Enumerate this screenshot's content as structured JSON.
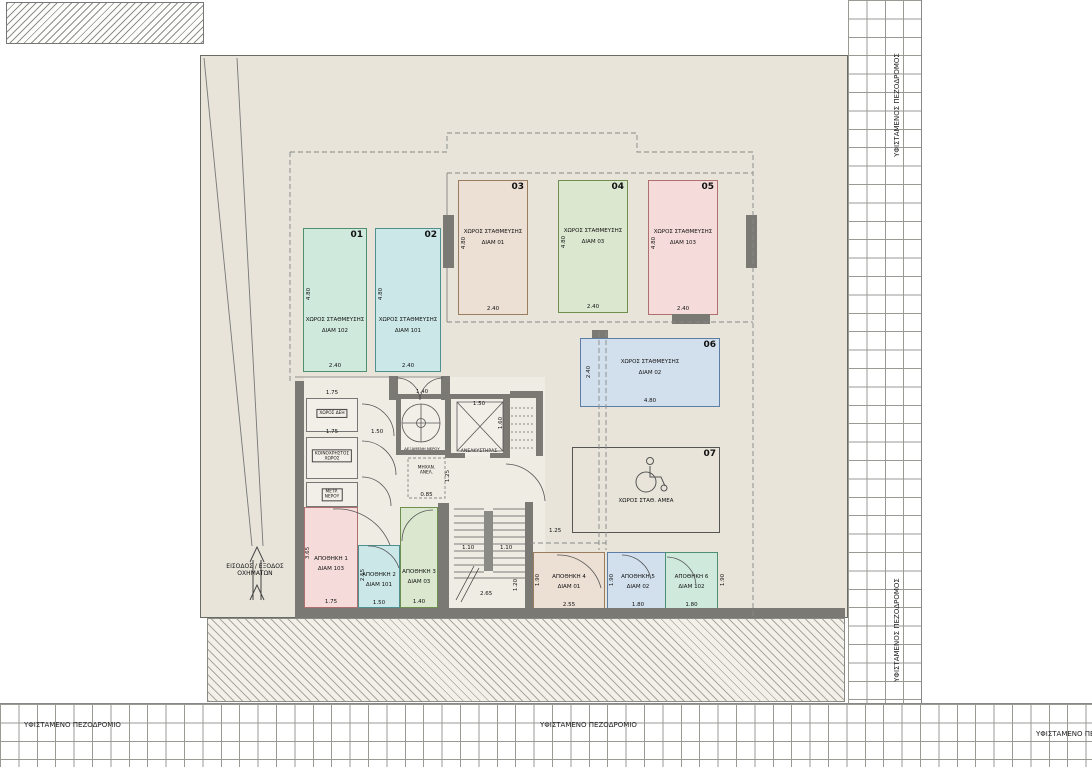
{
  "colors": {
    "plot_bg": "#e8e4da",
    "wall": "#7b7974",
    "p01": "#cfe9dd",
    "p02": "#cbe7e7",
    "p03": "#ecdfd4",
    "p04": "#dbe7cf",
    "p05": "#f5dcda",
    "p06": "#d2e0ee"
  },
  "parking": [
    {
      "num": "01",
      "name": "ΧΩΡΟΣ ΣΤΑΘΜΕΥΣΗΣ",
      "unit": "ΔΙΑΜ 102",
      "len": "4.80",
      "wid": "2.40"
    },
    {
      "num": "02",
      "name": "ΧΩΡΟΣ ΣΤΑΘΜΕΥΣΗΣ",
      "unit": "ΔΙΑΜ 101",
      "len": "4.80",
      "wid": "2.40"
    },
    {
      "num": "03",
      "name": "ΧΩΡΟΣ ΣΤΑΘΜΕΥΣΗΣ",
      "unit": "ΔΙΑΜ 01",
      "len": "4.80",
      "wid": "2.40"
    },
    {
      "num": "04",
      "name": "ΧΩΡΟΣ ΣΤΑΘΜΕΥΣΗΣ",
      "unit": "ΔΙΑΜ 03",
      "len": "4.80",
      "wid": "2.40"
    },
    {
      "num": "05",
      "name": "ΧΩΡΟΣ ΣΤΑΘΜΕΥΣΗΣ",
      "unit": "ΔΙΑΜ 103",
      "len": "4.80",
      "wid": "2.40"
    },
    {
      "num": "06",
      "name": "ΧΩΡΟΣ ΣΤΑΘΜΕΥΣΗΣ",
      "unit": "ΔΙΑΜ 02",
      "len": "4.80",
      "wid": "2.40"
    },
    {
      "num": "07",
      "name": "ΧΩΡΟΣ ΣΤΑΘ. ΑΜΕΑ"
    }
  ],
  "storage": [
    {
      "name": "ΑΠΟΘΗΚΗ 1",
      "unit": "ΔΙΑΜ 103",
      "h": "3.65",
      "w": "1.75",
      "w2": "1.75"
    },
    {
      "name": "ΑΠΟΘΗΚΗ 2",
      "unit": "ΔΙΑΜ 101",
      "h": "2.55",
      "w": "1.50"
    },
    {
      "name": "ΑΠΟΘΗΚΗ 3",
      "unit": "ΔΙΑΜ 03",
      "h": "3.45",
      "w": "1.40"
    },
    {
      "name": "ΑΠΟΘΗΚΗ 4",
      "unit": "ΔΙΑΜ 01",
      "h": "1.90",
      "w": "2.55"
    },
    {
      "name": "ΑΠΟΘΗΚΗ 5",
      "unit": "ΔΙΑΜ 02",
      "h": "1.90",
      "w": "1.80"
    },
    {
      "name": "ΑΠΟΘΗΚΗ 6",
      "unit": "ΔΙΑΜ 102",
      "h": "1.90",
      "w": "1.80"
    }
  ],
  "core": {
    "elevator": {
      "label": "ΑΝΕΛΚΥΣΤΗΡΑΣ",
      "w": "1.50",
      "h": "1.60"
    },
    "tank": {
      "label": "ΔΕΞΑΜΕΝΗ ΝΕΡΟΥ",
      "w": "1.40",
      "h": "2.00"
    },
    "machine": {
      "line1": "ΜΗΧΑΝ.",
      "line2": "ΑΝΕΛ.",
      "h": "1.25",
      "w": "0.85"
    },
    "meter_room": {
      "label": "ΧΩΡΟΣ ΔΕΗ",
      "w": "1.75",
      "h": "1.10"
    },
    "common_room": {
      "line1": "ΚΟΙΝΟΧΡΗΣΤΟΣ",
      "line2": "ΧΩΡΟΣ",
      "w": "1.75",
      "h": "1.60",
      "door": "1.50"
    },
    "water_meter": {
      "line1": "ΜΕΤΡ.",
      "line2": "ΝΕΡΟΥ",
      "h": "0.95",
      "w": "1.75"
    },
    "door_dim": "1.40",
    "stair": {
      "d1": "1.10",
      "d2": "1.10",
      "d3": "2.65",
      "d4": "1.20",
      "d5": "1.25"
    }
  },
  "entrance": {
    "line1": "ΕΙΣΟΔΟΣ / ΕΞΟΔΟΣ",
    "line2": "ΟΧΗΜΑΤΩΝ"
  },
  "sidewalks": {
    "bottom_left": "ΥΦΙΣΤΑΜΕΝΟ ΠΕΖΟΔΡΟΜΙΟ",
    "bottom_center": "ΥΦΙΣΤΑΜΕΝΟ ΠΕΖΟΔΡΟΜΙΟ",
    "bottom_right": "ΥΦΙΣΤΑΜΕΝΟ ΠΕΖ",
    "right_top": "ΥΦΙΣΤΑΜΕΝΟΣ ΠΕΖΟΔΡΟΜΟΣ",
    "right_bottom": "ΥΦΙΣΤΑΜΕΝΟΣ ΠΕΖΟΔΡΟΜΟΣ"
  }
}
